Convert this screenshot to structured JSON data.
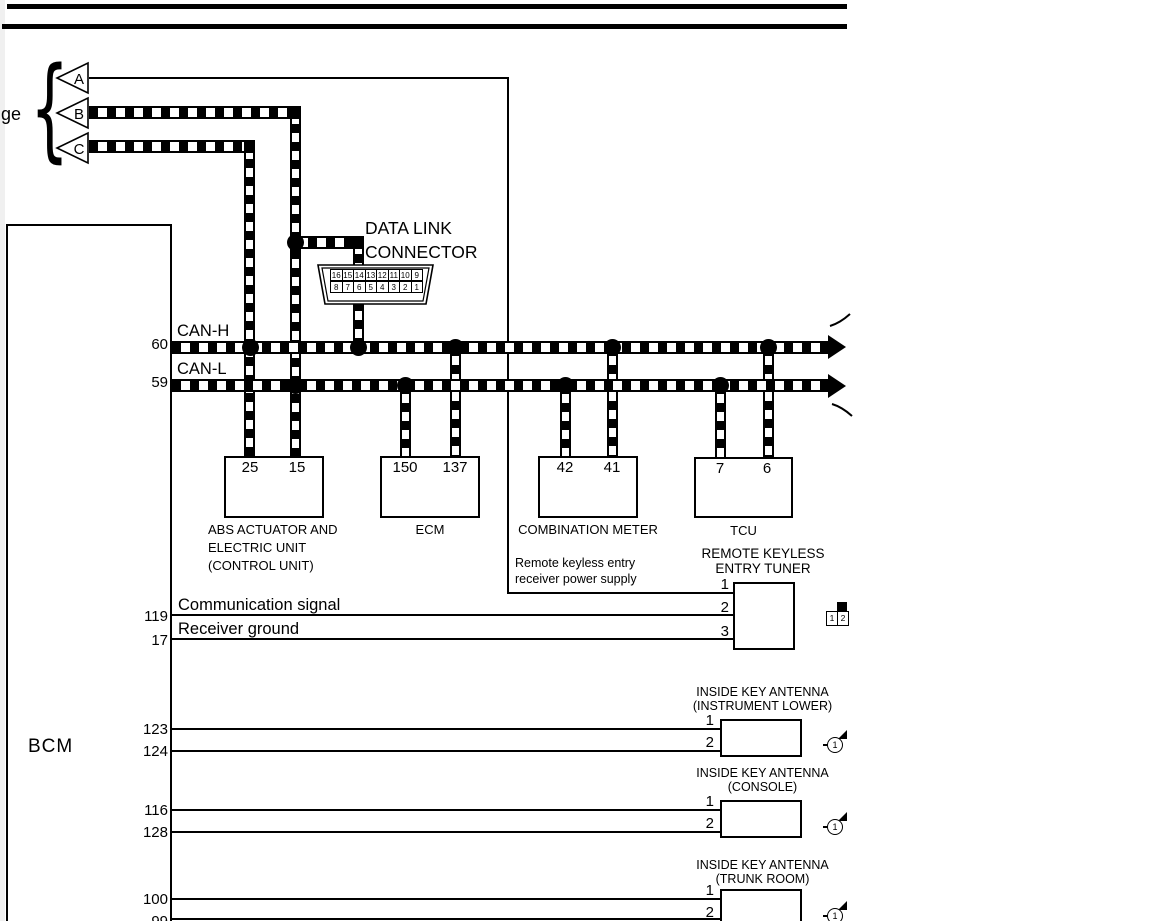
{
  "colors": {
    "ink": "#000000",
    "paper": "#ffffff"
  },
  "page": {
    "clipped_left_text": "ge"
  },
  "triangles": {
    "a": "A",
    "b": "B",
    "c": "C"
  },
  "dlc": {
    "title_line1": "DATA LINK",
    "title_line2": "CONNECTOR",
    "pins_top": [
      "16",
      "15",
      "14",
      "13",
      "12",
      "11",
      "10",
      "9"
    ],
    "pins_bottom": [
      "8",
      "7",
      "6",
      "5",
      "4",
      "3",
      "2",
      "1"
    ]
  },
  "bus": {
    "can_h": {
      "label": "CAN-H",
      "pin": "60"
    },
    "can_l": {
      "label": "CAN-L",
      "pin": "59"
    }
  },
  "components": [
    {
      "name_lines": [
        "ABS ACTUATOR AND",
        "ELECTRIC UNIT",
        "(CONTROL UNIT)"
      ],
      "pins": [
        "25",
        "15"
      ]
    },
    {
      "name_lines": [
        "ECM"
      ],
      "pins": [
        "150",
        "137"
      ]
    },
    {
      "name_lines": [
        "COMBINATION METER"
      ],
      "pins": [
        "42",
        "41"
      ]
    },
    {
      "name_lines": [
        "TCU"
      ],
      "pins": [
        "7",
        "6"
      ]
    }
  ],
  "tuner": {
    "title_line1": "REMOTE KEYLESS",
    "title_line2": "ENTRY TUNER",
    "power_label_line1": "Remote keyless entry",
    "power_label_line2": "receiver power supply",
    "signal1": "Communication signal",
    "signal2": "Receiver ground",
    "pins": [
      "1",
      "2",
      "3"
    ],
    "bcm_pins": [
      "119",
      "17"
    ],
    "inset_pins": [
      "1",
      "2"
    ]
  },
  "bcm": {
    "label": "BCM"
  },
  "antennas": [
    {
      "name_line1": "INSIDE KEY ANTENNA",
      "name_line2": "(INSTRUMENT LOWER)",
      "pins": [
        "1",
        "2"
      ],
      "bcm_pins": [
        "123",
        "124"
      ],
      "marker": "1"
    },
    {
      "name_line1": "INSIDE KEY ANTENNA",
      "name_line2": "(CONSOLE)",
      "pins": [
        "1",
        "2"
      ],
      "bcm_pins": [
        "116",
        "128"
      ],
      "marker": "1"
    },
    {
      "name_line1": "INSIDE KEY ANTENNA",
      "name_line2": "(TRUNK ROOM)",
      "pins": [
        "1",
        "2"
      ],
      "bcm_pins": [
        "100",
        "99"
      ],
      "marker": "1"
    }
  ]
}
